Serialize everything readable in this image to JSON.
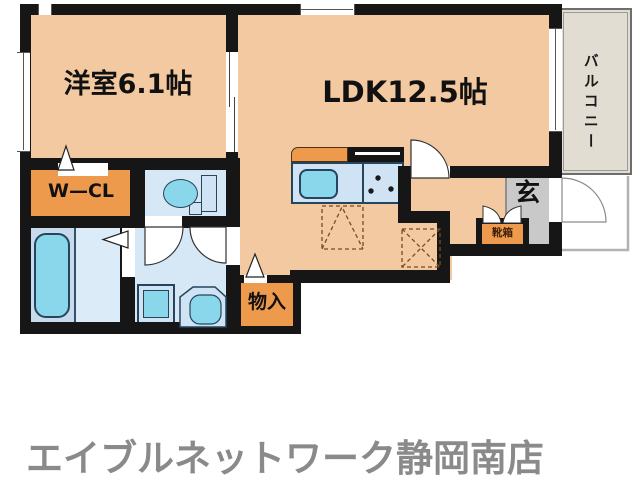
{
  "floorplan": {
    "rooms": {
      "western_room": {
        "label": "洋室6.1帖"
      },
      "ldk": {
        "label": "LDK12.5帖"
      },
      "walk_in_closet": {
        "label": "W—CL"
      },
      "balcony": {
        "label": "バルコニー"
      },
      "entrance": {
        "label": "玄"
      },
      "storage": {
        "label": "物入"
      },
      "shoe_box": {
        "label": "靴箱"
      }
    },
    "footer": {
      "store_name": "エイブルネットワーク静岡南店"
    },
    "colors": {
      "room_floor": "#f3c9a1",
      "accent_orange": "#ee9a4c",
      "wet_area_floor": "#d6e7f6",
      "fixture_cyan": "#8ad6ea",
      "wall": "#161616",
      "entrance_gray": "#c9c9c9",
      "balcony_fill": "#e2ddd3",
      "footer_text": "#8a8a8a"
    }
  }
}
